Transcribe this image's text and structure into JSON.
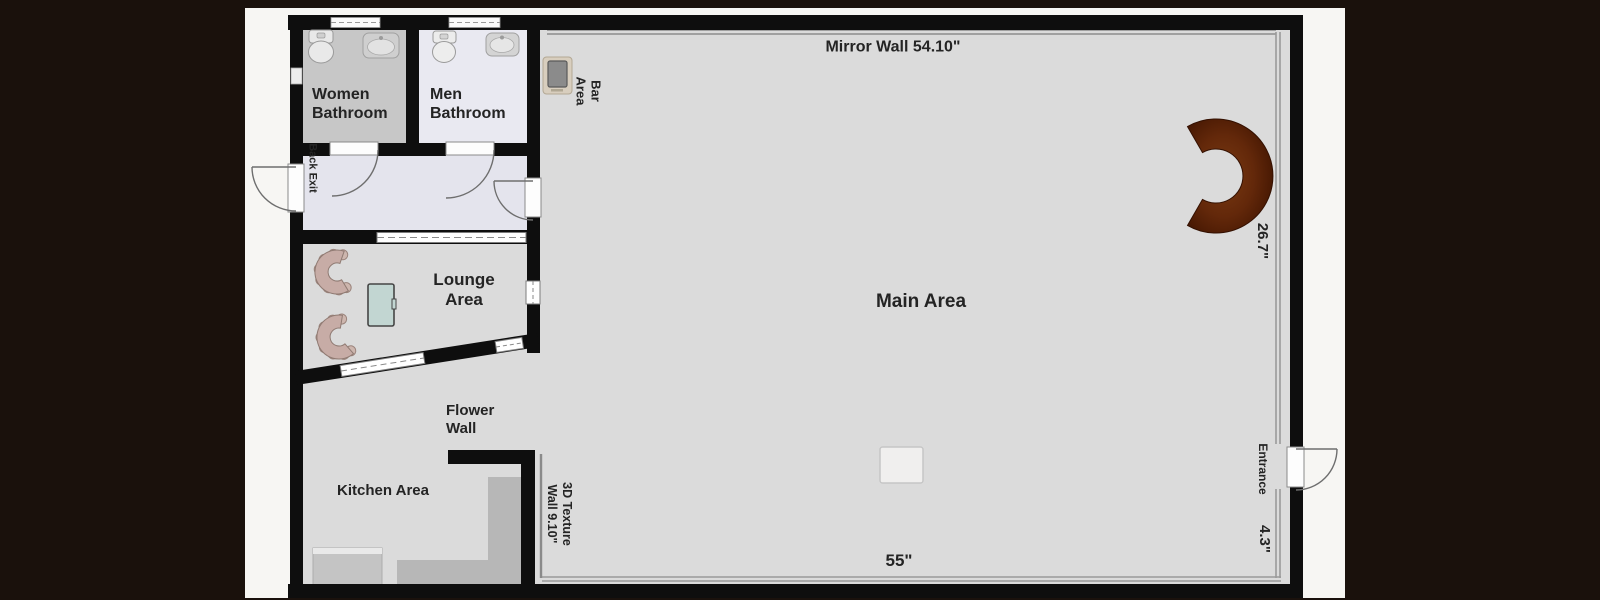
{
  "plan_title": "Dance studio floor plan",
  "rooms": {
    "women_bathroom": {
      "label_line1": "Women",
      "label_line2": "Bathroom"
    },
    "men_bathroom": {
      "label_line1": "Men",
      "label_line2": "Bathroom"
    },
    "back_exit": {
      "label": "Back Exit"
    },
    "bar_area": {
      "label_line1": "Bar",
      "label_line2": "Area"
    },
    "main_area": {
      "label": "Main Area"
    },
    "lounge_area": {
      "label_line1": "Lounge",
      "label_line2": "Area"
    },
    "kitchen_area": {
      "label": "Kitchen Area"
    },
    "flower_wall": {
      "label_line1": "Flower",
      "label_line2": "Wall"
    },
    "texture_wall": {
      "label_line1": "3D Texture",
      "label_line2": "Wall 9.10\""
    },
    "mirror_wall": {
      "label": "Mirror Wall 54.10\""
    },
    "entrance": {
      "label": "Entrance"
    }
  },
  "dimensions": {
    "mirror_wall_length": "54.10\"",
    "right_wall": "26.7\"",
    "bottom_wall": "55\"",
    "entrance_offset": "4.3\"",
    "texture_wall_length": "9.10\""
  },
  "colors": {
    "surround": "#1a110c",
    "page": "#f7f6f3",
    "wall": "#0e0e0e",
    "floor_main": "#dbdbdb",
    "floor_hallway": "#e4e4ed",
    "floor_women_bathroom": "#c7c7c7",
    "floor_men_bathroom": "#e9e9f1",
    "bar_counter": "#5e2407",
    "kitchen_counter": "#b7b7b7",
    "sofa": "#c7aca6",
    "coffee_table": "#c2d6d2",
    "thin_wall_line": "#8c8c8c"
  },
  "icons": {
    "toilet": "toilet-icon",
    "sink": "sink-icon",
    "wall_screen": "tablet-icon",
    "bar_counter": "bar-counter-icon",
    "sofa": "sofa-icon",
    "coffee_table": "coffee-table-icon",
    "door": "door-swing-icon",
    "window": "window-icon",
    "floor_marker": "dance-floor-marker"
  }
}
